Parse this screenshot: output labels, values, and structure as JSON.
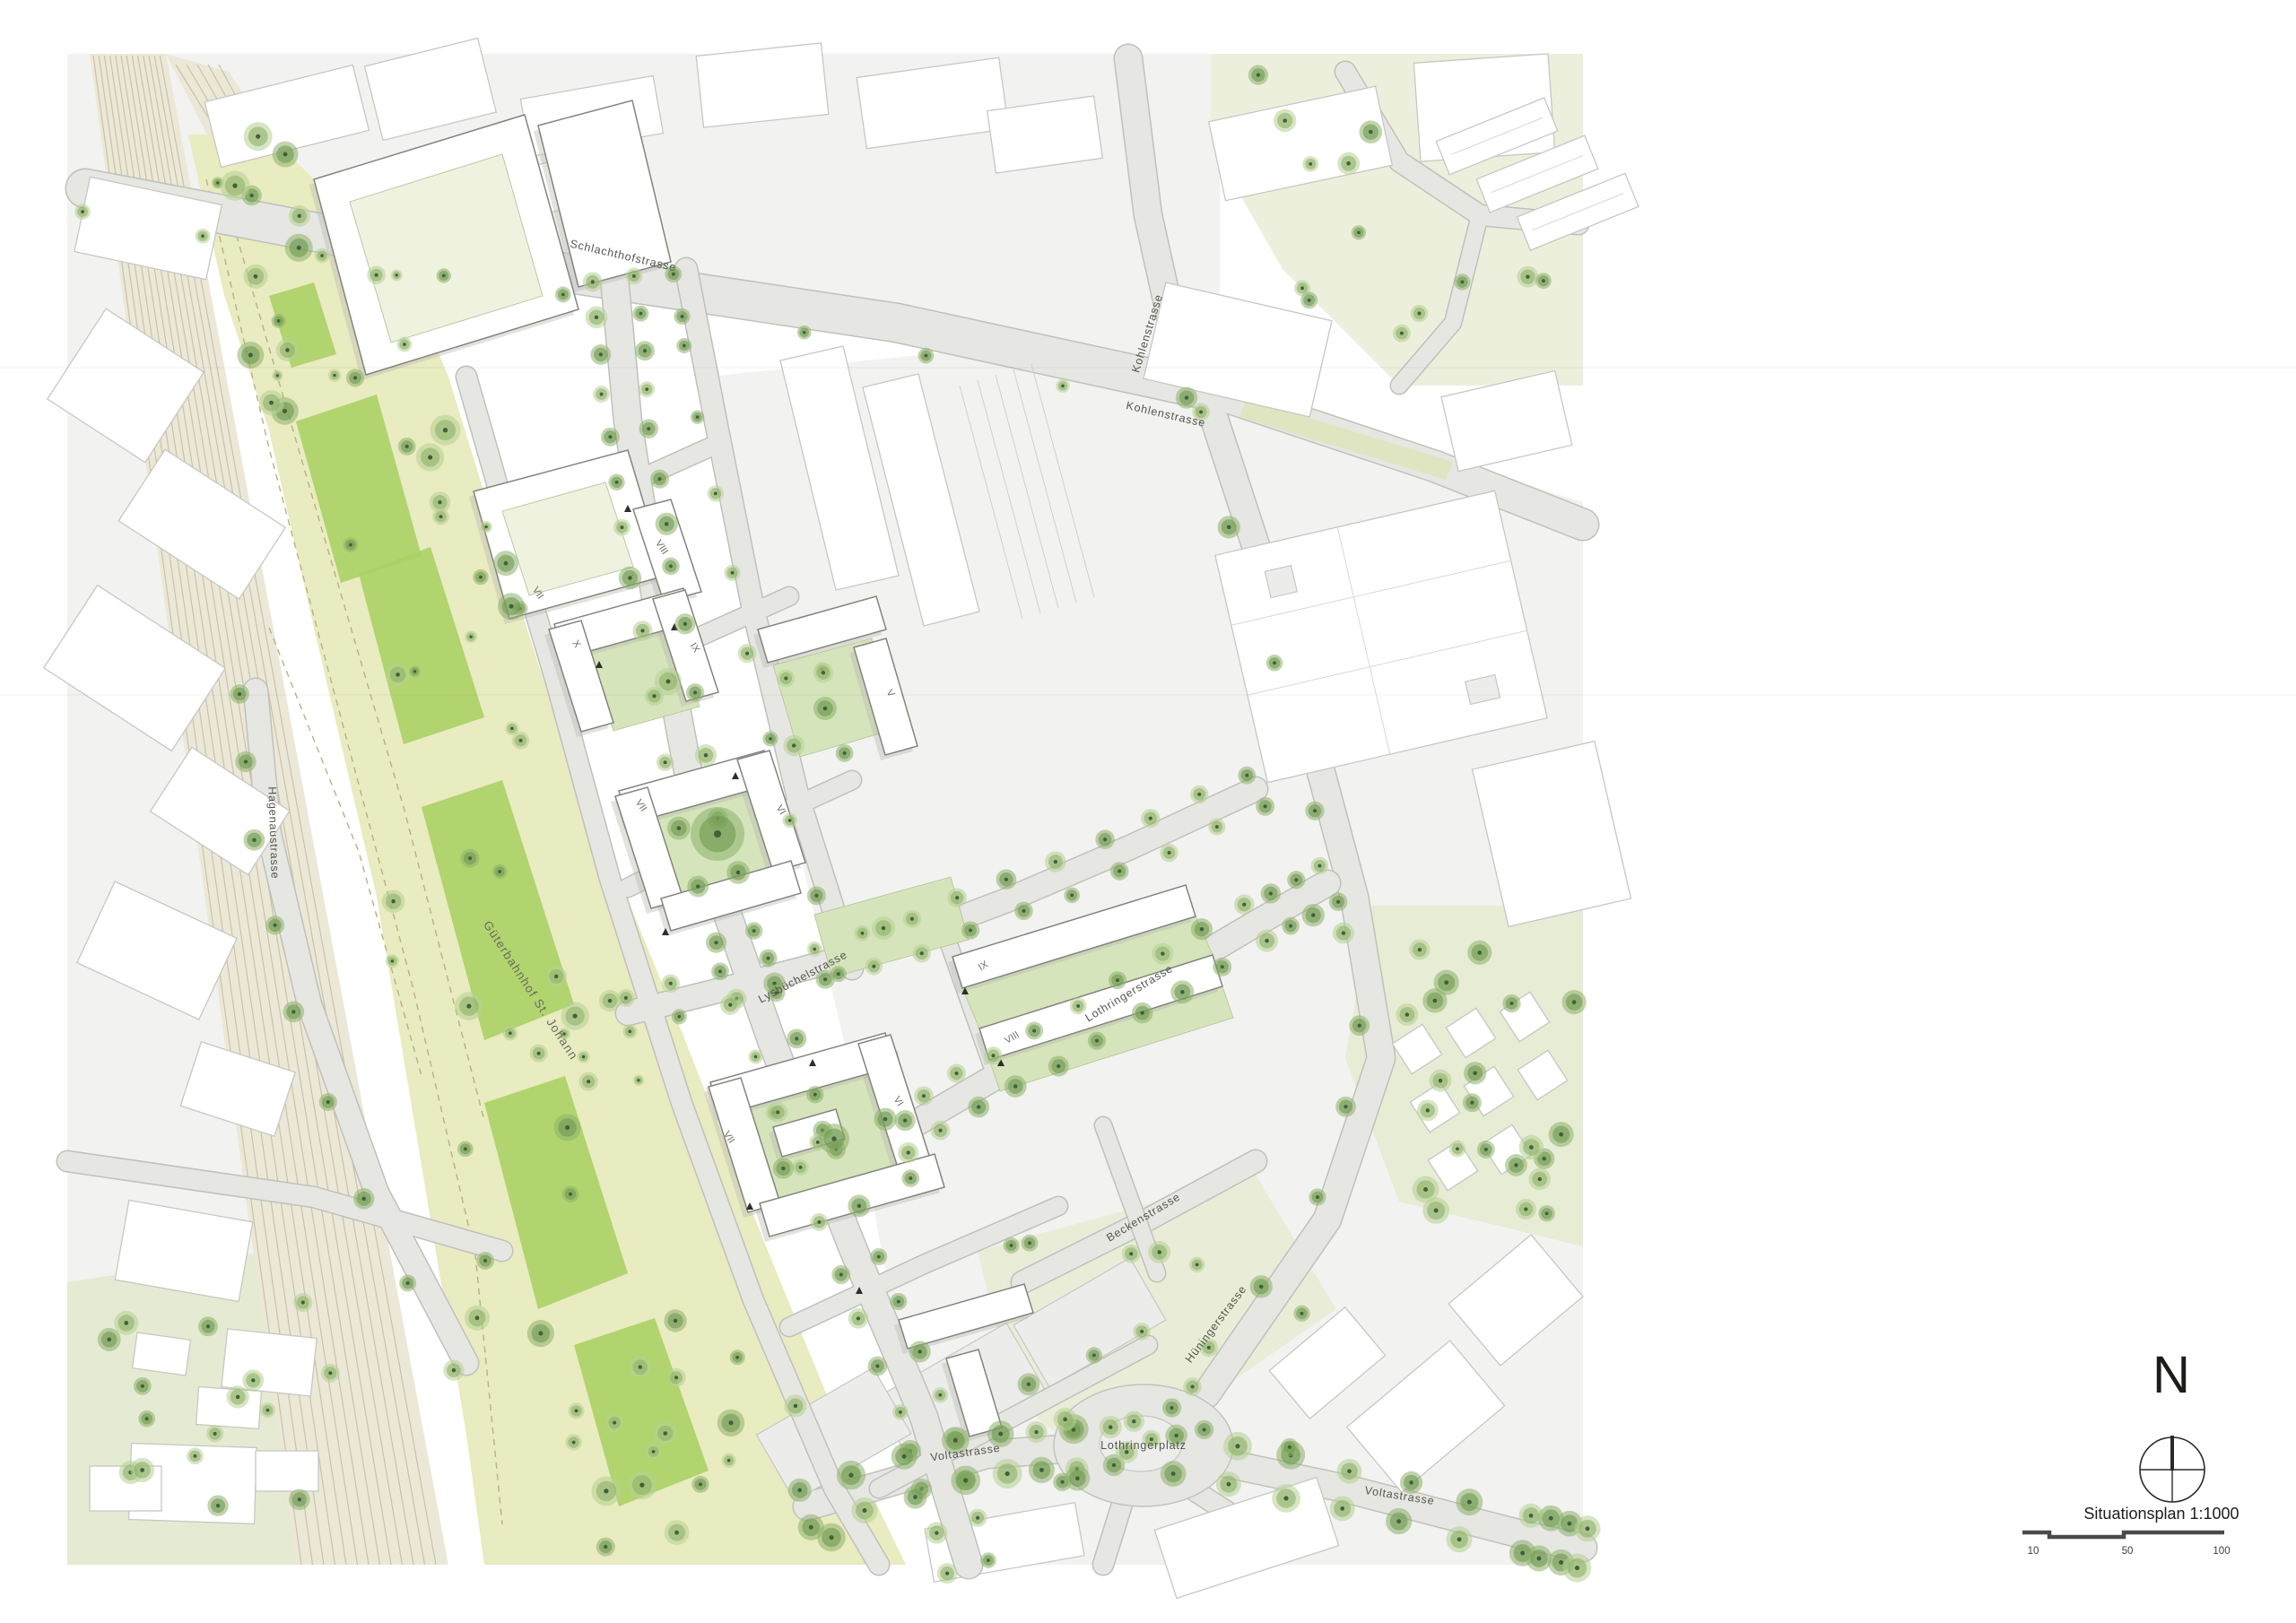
{
  "map": {
    "street_labels": [
      "Schlachthofstrasse",
      "Kohlenstrasse",
      "Kohlenstrasse",
      "Hagenaustrasse",
      "Güterbahnhof St. Johann",
      "Lysbüchelstrasse",
      "Lothringerstrasse",
      "Beckenstrasse",
      "Hüningerstrasse",
      "Voltastrasse",
      "Voltastrasse",
      "Lothringerplatz"
    ],
    "building_labels": [
      "VII",
      "VIII",
      "I",
      "X",
      "IX",
      "VII",
      "VI",
      "IX",
      "VIII",
      "VII",
      "VI",
      "V"
    ]
  },
  "legend": {
    "north_label": "N",
    "compass_icon": "compass-crosshair",
    "caption": "Situationsplan 1:1000",
    "scale_ticks": [
      "10",
      "50",
      "100"
    ]
  },
  "colors": {
    "page_bg": "#ffffff",
    "context_fill": "#f2f2f0",
    "context_building_stroke": "#c7c7c3",
    "road_fill": "#e6e6e3",
    "road_casing": "#c0c0bc",
    "site_building_stroke": "#84847e",
    "building_shadow": "#b9b9b2",
    "rail_bg": "#ece8d8",
    "rail_line": "#c9c2a8",
    "park_green": "#e9ebc0",
    "lawn_green": "#a9d063",
    "courtyard_green": "#d5e4ba",
    "map_text": "#55554e",
    "legend_text": "#1c1c1a",
    "tree_dark": "#6f9a52",
    "tree_mid": "#8db069",
    "tree_light": "#b5cf92"
  }
}
